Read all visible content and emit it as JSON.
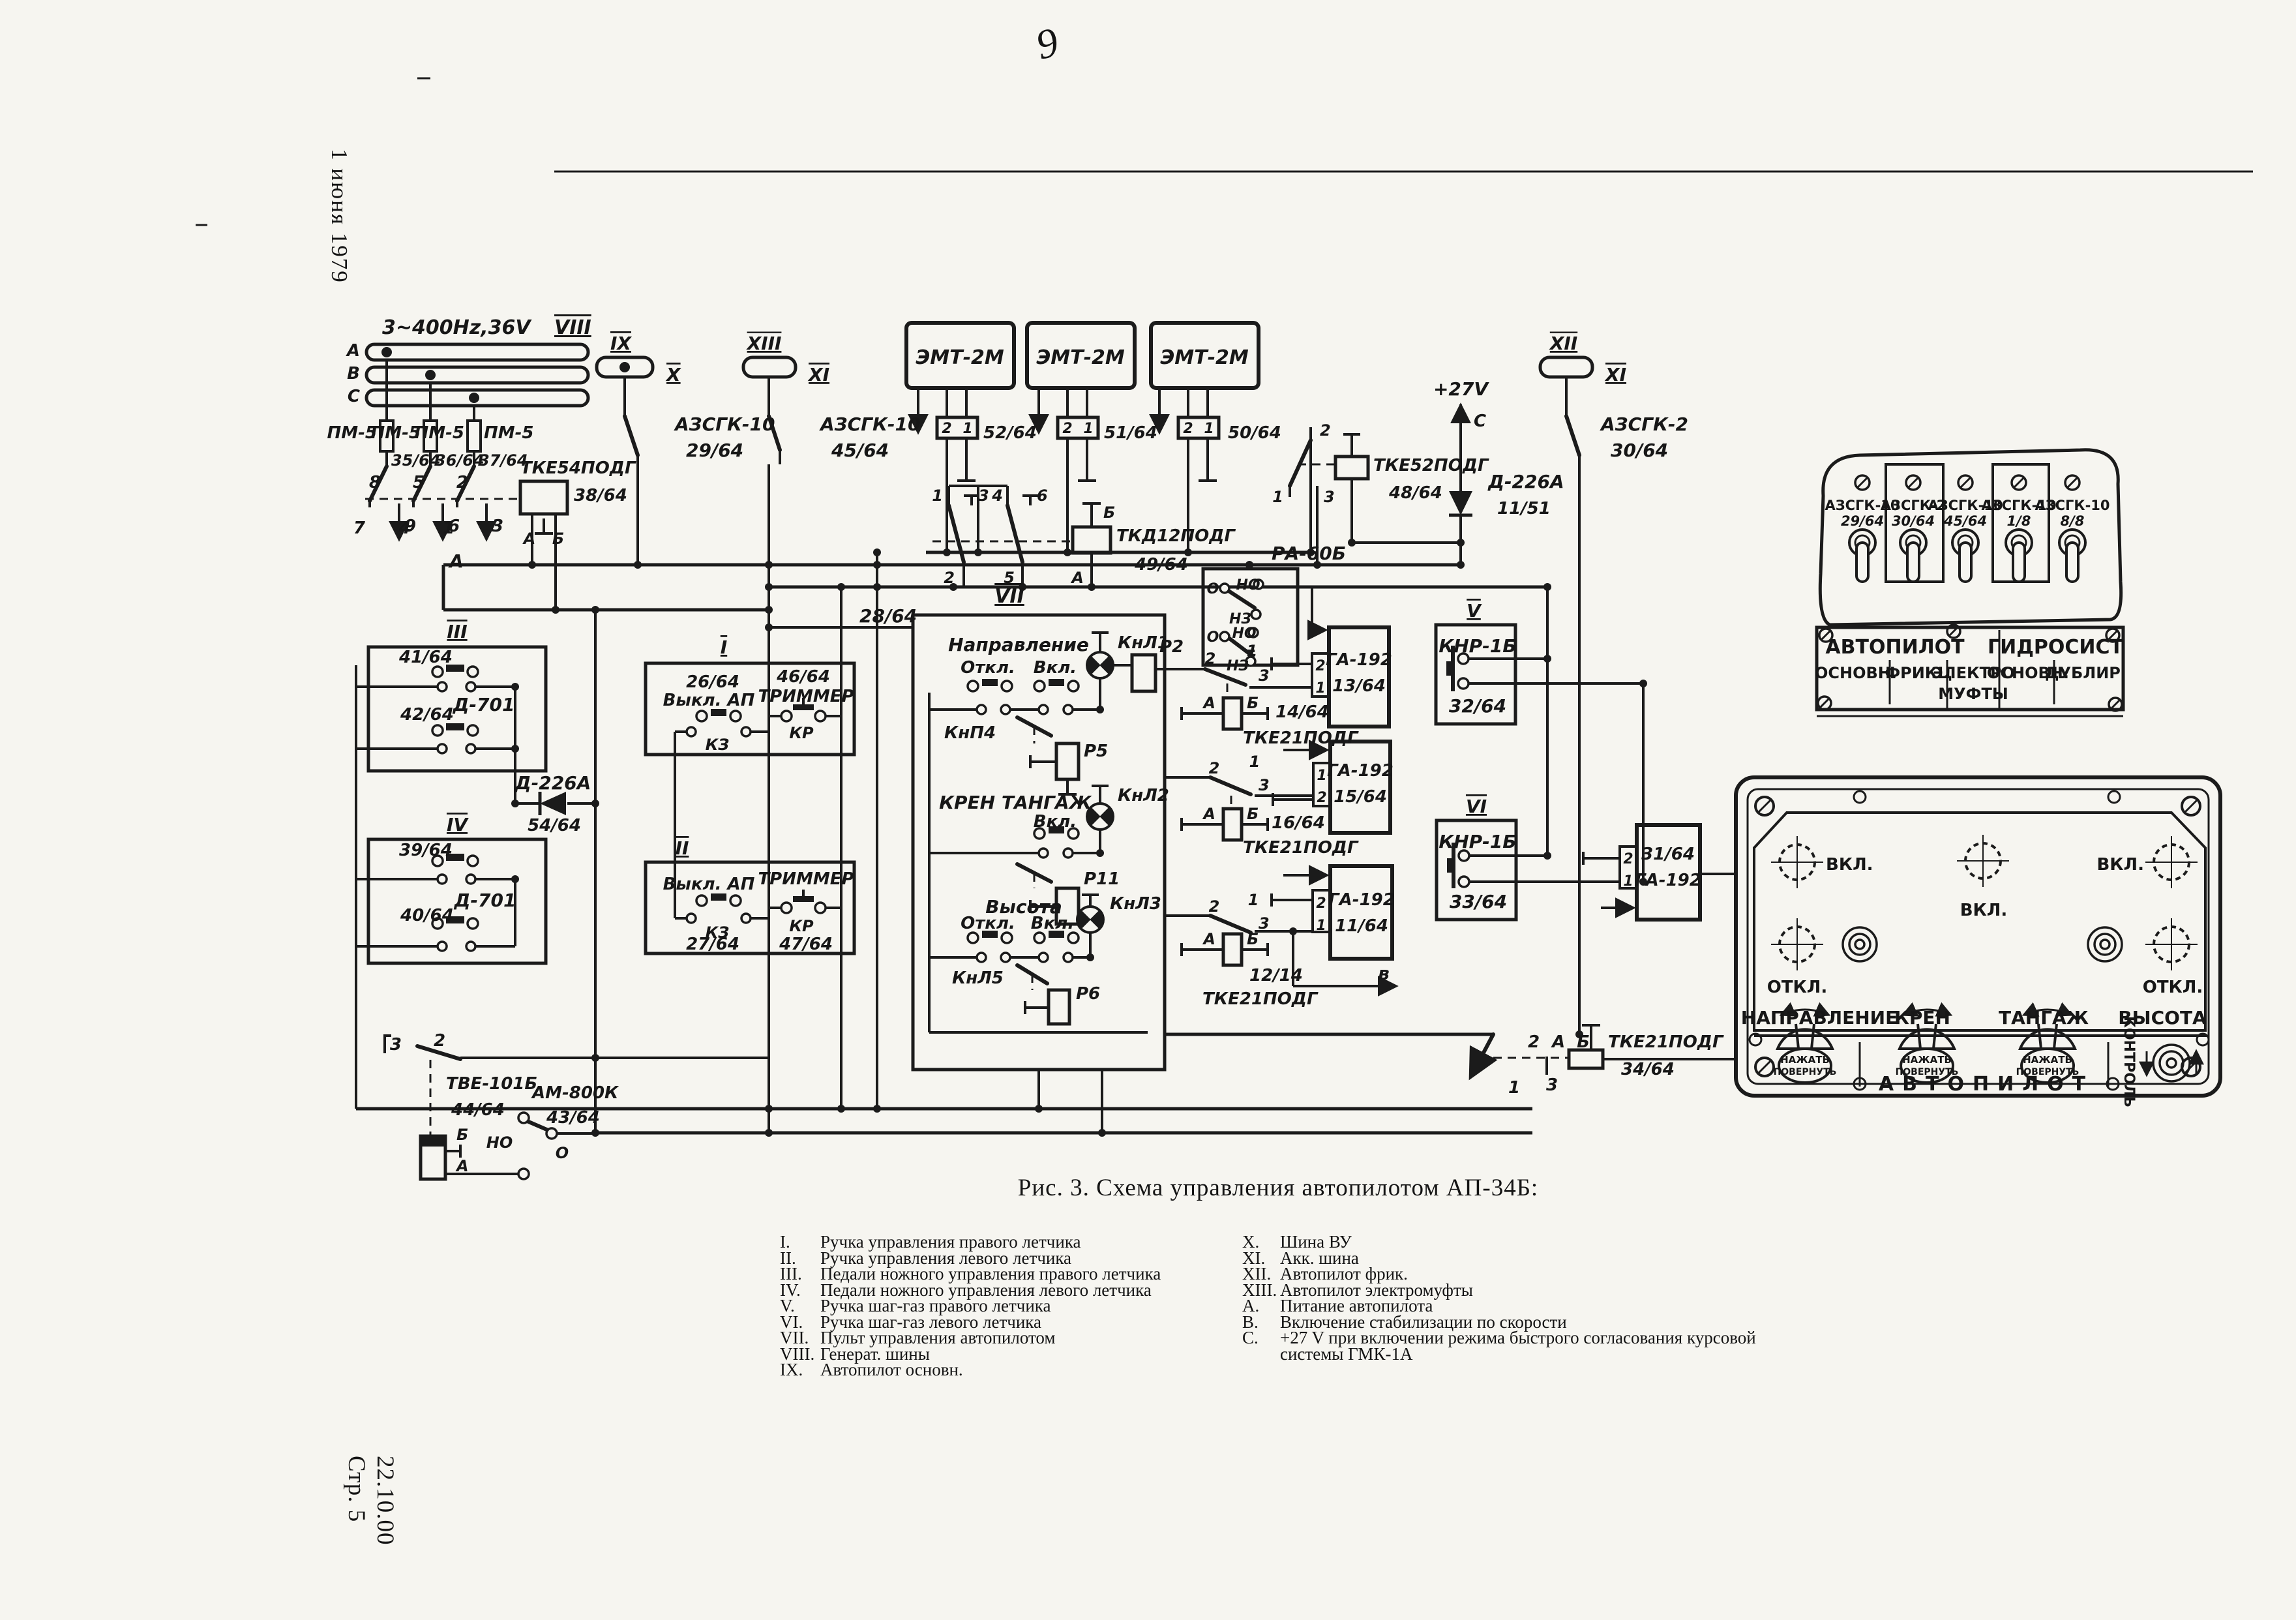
{
  "page": {
    "date_note": "1 июня 1979",
    "doc_code": "22.10.00",
    "page_num": "Стр. 5",
    "handwritten_mark": "9",
    "caption": "Рис. 3. Схема управления автопилотом АП-34Б:"
  },
  "legend": {
    "left": [
      {
        "num": "I.",
        "text": "Ручка управления правого летчика"
      },
      {
        "num": "II.",
        "text": "Ручка управления левого летчика"
      },
      {
        "num": "III.",
        "text": "Педали ножного управления правого летчика"
      },
      {
        "num": "IV.",
        "text": "Педали ножного управления левого летчика"
      },
      {
        "num": "V.",
        "text": "Ручка шаг-газ правого летчика"
      },
      {
        "num": "VI.",
        "text": "Ручка шаг-газ левого летчика"
      },
      {
        "num": "VII.",
        "text": "Пульт управления автопилотом"
      },
      {
        "num": "VIII.",
        "text": "Генерат. шины"
      },
      {
        "num": "IX.",
        "text": "Автопилот основн."
      }
    ],
    "right": [
      {
        "num": "X.",
        "text": "Шина ВУ"
      },
      {
        "num": "XI.",
        "text": "Акк. шина"
      },
      {
        "num": "XII.",
        "text": "Автопилот фрик."
      },
      {
        "num": "XIII.",
        "text": "Автопилот электромуфты"
      },
      {
        "num": "A.",
        "text": "Питание автопилота"
      },
      {
        "num": "B.",
        "text": "Включение стабилизации по скорости"
      },
      {
        "num": "C.",
        "text": "+27 V при включении режима быстрого согласования курсовой системы ГМК-1А"
      }
    ]
  },
  "sch": {
    "power": {
      "bus": "3~400Hz,36V",
      "num": "VIII",
      "ph_a": "А",
      "ph_b": "В",
      "ph_c": "С",
      "fuse": "ПМ-5",
      "fw1": "35/64",
      "fw2": "36/64",
      "fw3": "37/64",
      "t1": "8",
      "t2": "5",
      "t3": "2",
      "b1": "7",
      "b2": "9",
      "b3": "4",
      "b4": "6",
      "b5": "1",
      "b6": "3",
      "relay": "ТКЕ54ПОДГ",
      "rwire": "38/64",
      "ra": "А",
      "rb": "Б",
      "marker": "А"
    },
    "busIX": {
      "num": "IX",
      "side": "X",
      "brk": "АЗСГК-10",
      "wire": "29/64"
    },
    "busXIII": {
      "num": "XIII",
      "side": "XI",
      "brk": "АЗСГК-10",
      "wire": "45/64"
    },
    "busXII": {
      "num": "XII",
      "side": "XI",
      "brk": "АЗСГК-2",
      "wire": "30/64"
    },
    "p27": {
      "label": "+27V",
      "marker": "С",
      "diode": "Д-226А",
      "wire": "11/51"
    },
    "emt": {
      "name": "ЭМТ-2М",
      "w1": "52/64",
      "w2": "51/64",
      "w3": "50/64",
      "t2": "2",
      "t1": "1"
    },
    "tkd": {
      "name": "ТКД12ПОДГ",
      "wire": "49/64",
      "c1": "1",
      "c3": "3",
      "c4": "4",
      "c6": "6",
      "c2": "2",
      "c5": "5",
      "ta": "А",
      "tb": "Б"
    },
    "tke52": {
      "name": "ТКЕ52ПОДГ",
      "wire": "48/64",
      "c2": "2",
      "c1": "1",
      "c3": "3"
    },
    "ra60": {
      "name": "РА-60Б",
      "o": "О",
      "no": "НО",
      "nz": "НЗ"
    },
    "b3": {
      "num": "III",
      "w1": "41/64",
      "w2": "42/64",
      "dev": "Д-701"
    },
    "b4": {
      "num": "IV",
      "w1": "39/64",
      "w2": "40/64",
      "dev": "Д-701"
    },
    "d54": {
      "name": "Д-226А",
      "wire": "54/64"
    },
    "b1": {
      "num": "I",
      "w1": "26/64",
      "sw": "Выкл. АП",
      "k": "КЗ",
      "w2": "46/64",
      "btn": "ТРИММЕР",
      "kr": "КР"
    },
    "b2": {
      "num": "II",
      "sw": "Выкл. АП",
      "k": "КЗ",
      "w1": "27/64",
      "btn": "ТРИММЕР",
      "kr": "КР",
      "w2": "47/64"
    },
    "b7": {
      "num": "VII",
      "wire": "28/64",
      "off": "Откл.",
      "on": "Вкл.",
      "t1": "Направление",
      "l1": "КнЛ1",
      "r1": "Р2",
      "btn1": "КнП4",
      "r1b": "Р5",
      "t2": "КРЕН ТАНГАЖ",
      "l2": "КнЛ2",
      "r2": "Р11",
      "t3": "Высота",
      "l3": "КнЛ3",
      "btn3": "КнЛ5",
      "r3": "Р6"
    },
    "ga1": {
      "name": "ГА-192",
      "wire": "13/64",
      "tt": "2",
      "tb": "1",
      "s1": "1",
      "s2": "2",
      "s3": "3"
    },
    "co1": {
      "a": "А",
      "b": "Б",
      "wire": "14/64",
      "name": "ТКЕ21ПОДГ"
    },
    "ga2": {
      "name": "ГА-192",
      "wire": "15/64",
      "tt": "1",
      "tb": "2",
      "s1": "1",
      "s2": "2",
      "s3": "3"
    },
    "co2": {
      "a": "А",
      "b": "Б",
      "wire": "16/64",
      "name": "ТКЕ21ПОДГ"
    },
    "ga3": {
      "name": "ГА-192",
      "wire": "11/64",
      "tt": "2",
      "tb": "1",
      "s1": "1",
      "s2": "2",
      "s3": "3",
      "marker": "в"
    },
    "co3": {
      "a": "А",
      "b": "Б",
      "wire": "12/14",
      "name": "ТКЕ21ПОДГ"
    },
    "ga4": {
      "wire": "31/64",
      "name": "ГА-192",
      "tt": "2",
      "tb": "1"
    },
    "bV": {
      "num": "V",
      "name": "КНР-1Б",
      "wire": "32/64"
    },
    "bVI": {
      "num": "VI",
      "name": "КНР-1Б",
      "wire": "33/64"
    },
    "tke34": {
      "c2": "2",
      "ta": "А",
      "tb": "Б",
      "name": "ТКЕ21ПОДГ",
      "wire": "34/64",
      "c1": "1",
      "c3": "3"
    },
    "tve": {
      "name": "ТВЕ-101Б",
      "wire": "44/64",
      "tb": "Б",
      "ta": "А",
      "c3": "3",
      "c2": "2"
    },
    "am": {
      "name": "АМ-800К",
      "wire": "43/64",
      "no": "НО",
      "o": "О"
    }
  },
  "brk_panel": {
    "s1l": "АЗСГК-10",
    "s1w": "29/64",
    "s2l": "АЗСГК-2",
    "s2w": "30/64",
    "s3l": "АЗСГК-10",
    "s3w": "45/64",
    "s4l": "АЗСГК-10",
    "s4w": "1/8",
    "s5l": "АЗСГК-10",
    "s5w": "8/8",
    "g1": "АВТОПИЛОТ",
    "g2": "ГИДРОСИСТ",
    "c1": "ОСНОВН.",
    "c2": "ФРИКЦ",
    "c3": "ЭЛЕКТРО",
    "c4": "МУФТЫ",
    "c5": "ОСНОВН.",
    "c6": "ДУБЛИР"
  },
  "ap_panel": {
    "on": "ВКЛ.",
    "off": "ОТКЛ.",
    "ch1": "НАПРАВЛЕНИЕ",
    "ch2": "КРЕН",
    "ch3": "ТАНГАЖ",
    "ch4": "ВЫСОТА",
    "kn1": "НАЖАТЬ",
    "kn2": "ПОВЕРНУТЬ",
    "ctrl": "КОНТРОЛЬ",
    "title": "АВТОПИЛОТ"
  }
}
